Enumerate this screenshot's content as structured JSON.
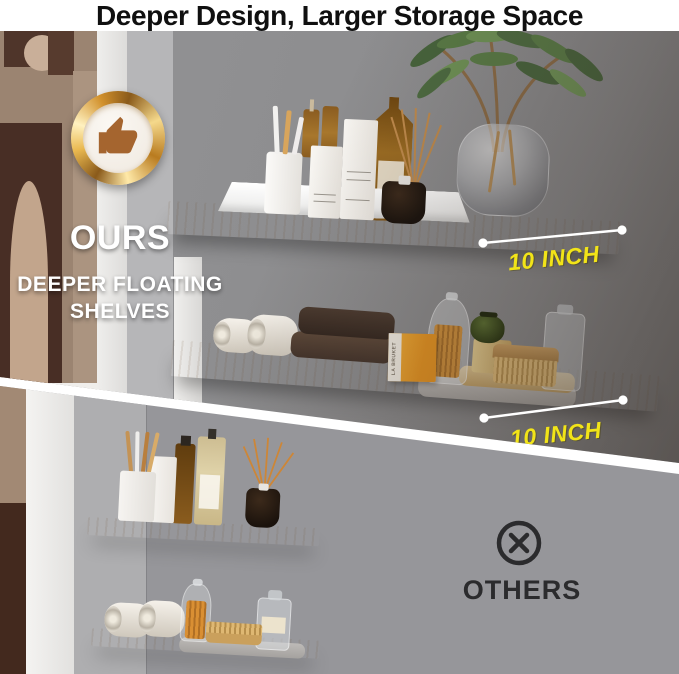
{
  "header": {
    "title": "Deeper Design, Larger Storage Space"
  },
  "ours": {
    "badge_icon": "thumbs-up-icon",
    "label": "OURS",
    "subtitle_line1": "DEEPER FLOATING",
    "subtitle_line2": "SHELVES",
    "measurements": [
      {
        "label": "10 INCH"
      },
      {
        "label": "10 INCH"
      }
    ],
    "soap_label": "LA BRUKET"
  },
  "others": {
    "icon": "circle-x-icon",
    "label": "OTHERS"
  },
  "colors": {
    "accent_yellow": "#F2E418",
    "badge_gold": "#D99A2B",
    "wood": "#B1947A",
    "ours_wall": "#8D8D8F",
    "others_wall": "#97979A",
    "icon_dark": "#2B2B2D",
    "title_text": "#101010",
    "light_text": "#FFFFFF"
  }
}
